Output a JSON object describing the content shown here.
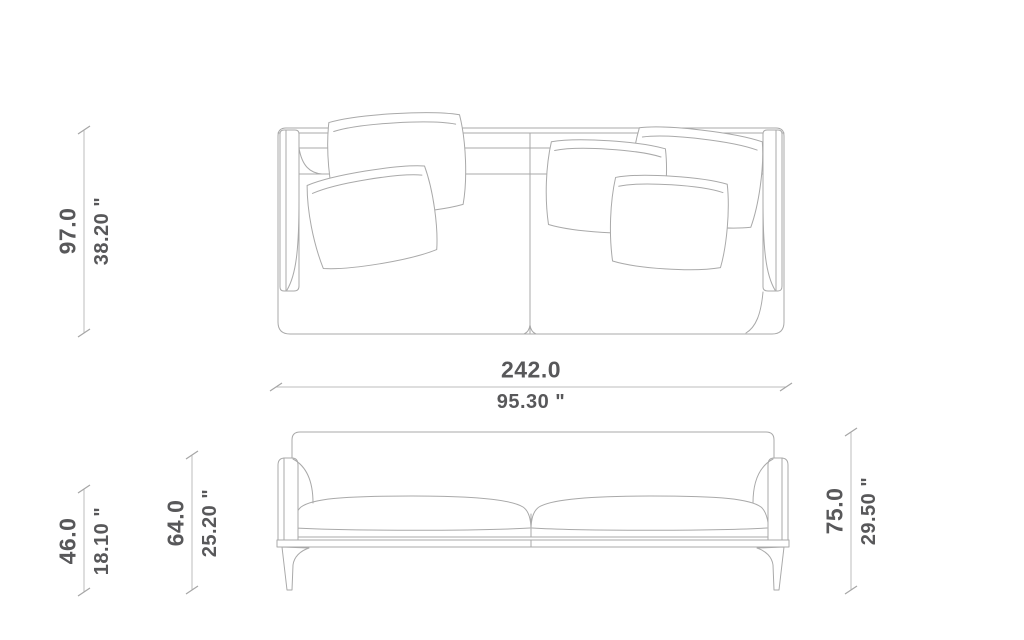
{
  "dimensions": {
    "depth": {
      "cm": "97.0",
      "inches": "38.20 \""
    },
    "width": {
      "cm": "242.0",
      "inches": "95.30 \""
    },
    "seat_height": {
      "cm": "46.0",
      "inches": "18.10 \""
    },
    "arm_height": {
      "cm": "64.0",
      "inches": "25.20 \""
    },
    "overall_height": {
      "cm": "75.0",
      "inches": "29.50 \""
    }
  },
  "colors": {
    "background": "#ffffff",
    "drawing_line": "#a9a9a9",
    "dimension_line": "#bdbdbd",
    "tick_line": "#a6a6a6",
    "dimension_text": "#58585a"
  }
}
